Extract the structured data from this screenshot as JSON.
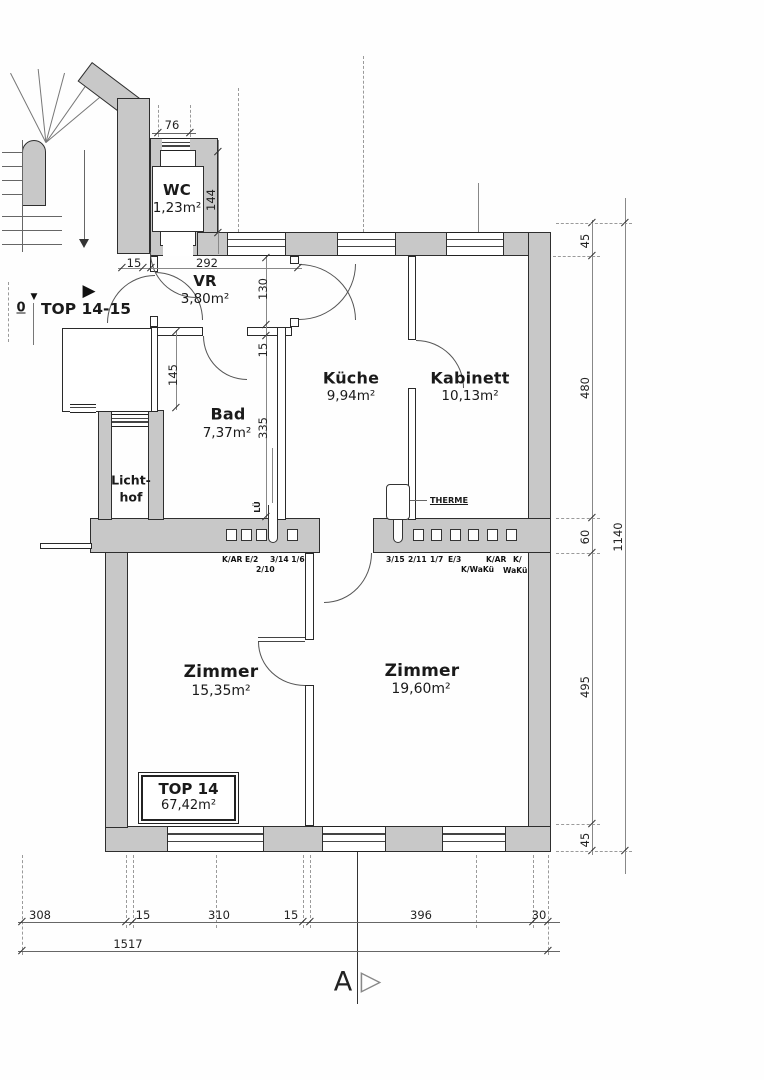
{
  "markers": {
    "level": "0",
    "level_icon": "▼",
    "entry_icon": "▶",
    "top_label": "TOP 14-15",
    "section_letter": "A",
    "section_icon": "▷"
  },
  "rooms": {
    "wc": {
      "name": "WC",
      "area": "1,23m²"
    },
    "vr": {
      "name": "VR",
      "area": "3,80m²"
    },
    "bad": {
      "name": "Bad",
      "area": "7,37m²"
    },
    "kueche": {
      "name": "Küche",
      "area": "9,94m²"
    },
    "kabinett": {
      "name": "Kabinett",
      "area": "10,13m²"
    },
    "lichthof": {
      "line1": "Licht-",
      "line2": "hof"
    },
    "zimmer1": {
      "name": "Zimmer",
      "area": "15,35m²"
    },
    "zimmer2": {
      "name": "Zimmer",
      "area": "19,60m²"
    }
  },
  "unit": {
    "name": "TOP 14",
    "area": "67,42m²"
  },
  "equipment": {
    "therme": "THERME",
    "lueftung": "LÜ"
  },
  "flues": {
    "l1": "K/AR E/2",
    "l2": "3/14 1/6",
    "l3": "2/10",
    "r1": "3/15",
    "r2": "2/11",
    "r3": "1/7",
    "r4": "E/3",
    "r5": "K/AR",
    "r6": "K/",
    "r7": "K/WaKü",
    "r8": "WaKü"
  },
  "dims": {
    "d76": "76",
    "d144": "144",
    "d15a": "15",
    "d292": "292",
    "d130": "130",
    "d15b": "15",
    "d335": "335",
    "d145": "145",
    "r45a": "45",
    "r480": "480",
    "r60": "60",
    "r495": "495",
    "r45b": "45",
    "rtotal": "1140",
    "b308": "308",
    "b15a": "15",
    "b310": "310",
    "b15b": "15",
    "b396": "396",
    "b30": "30",
    "btotal": "1517"
  }
}
